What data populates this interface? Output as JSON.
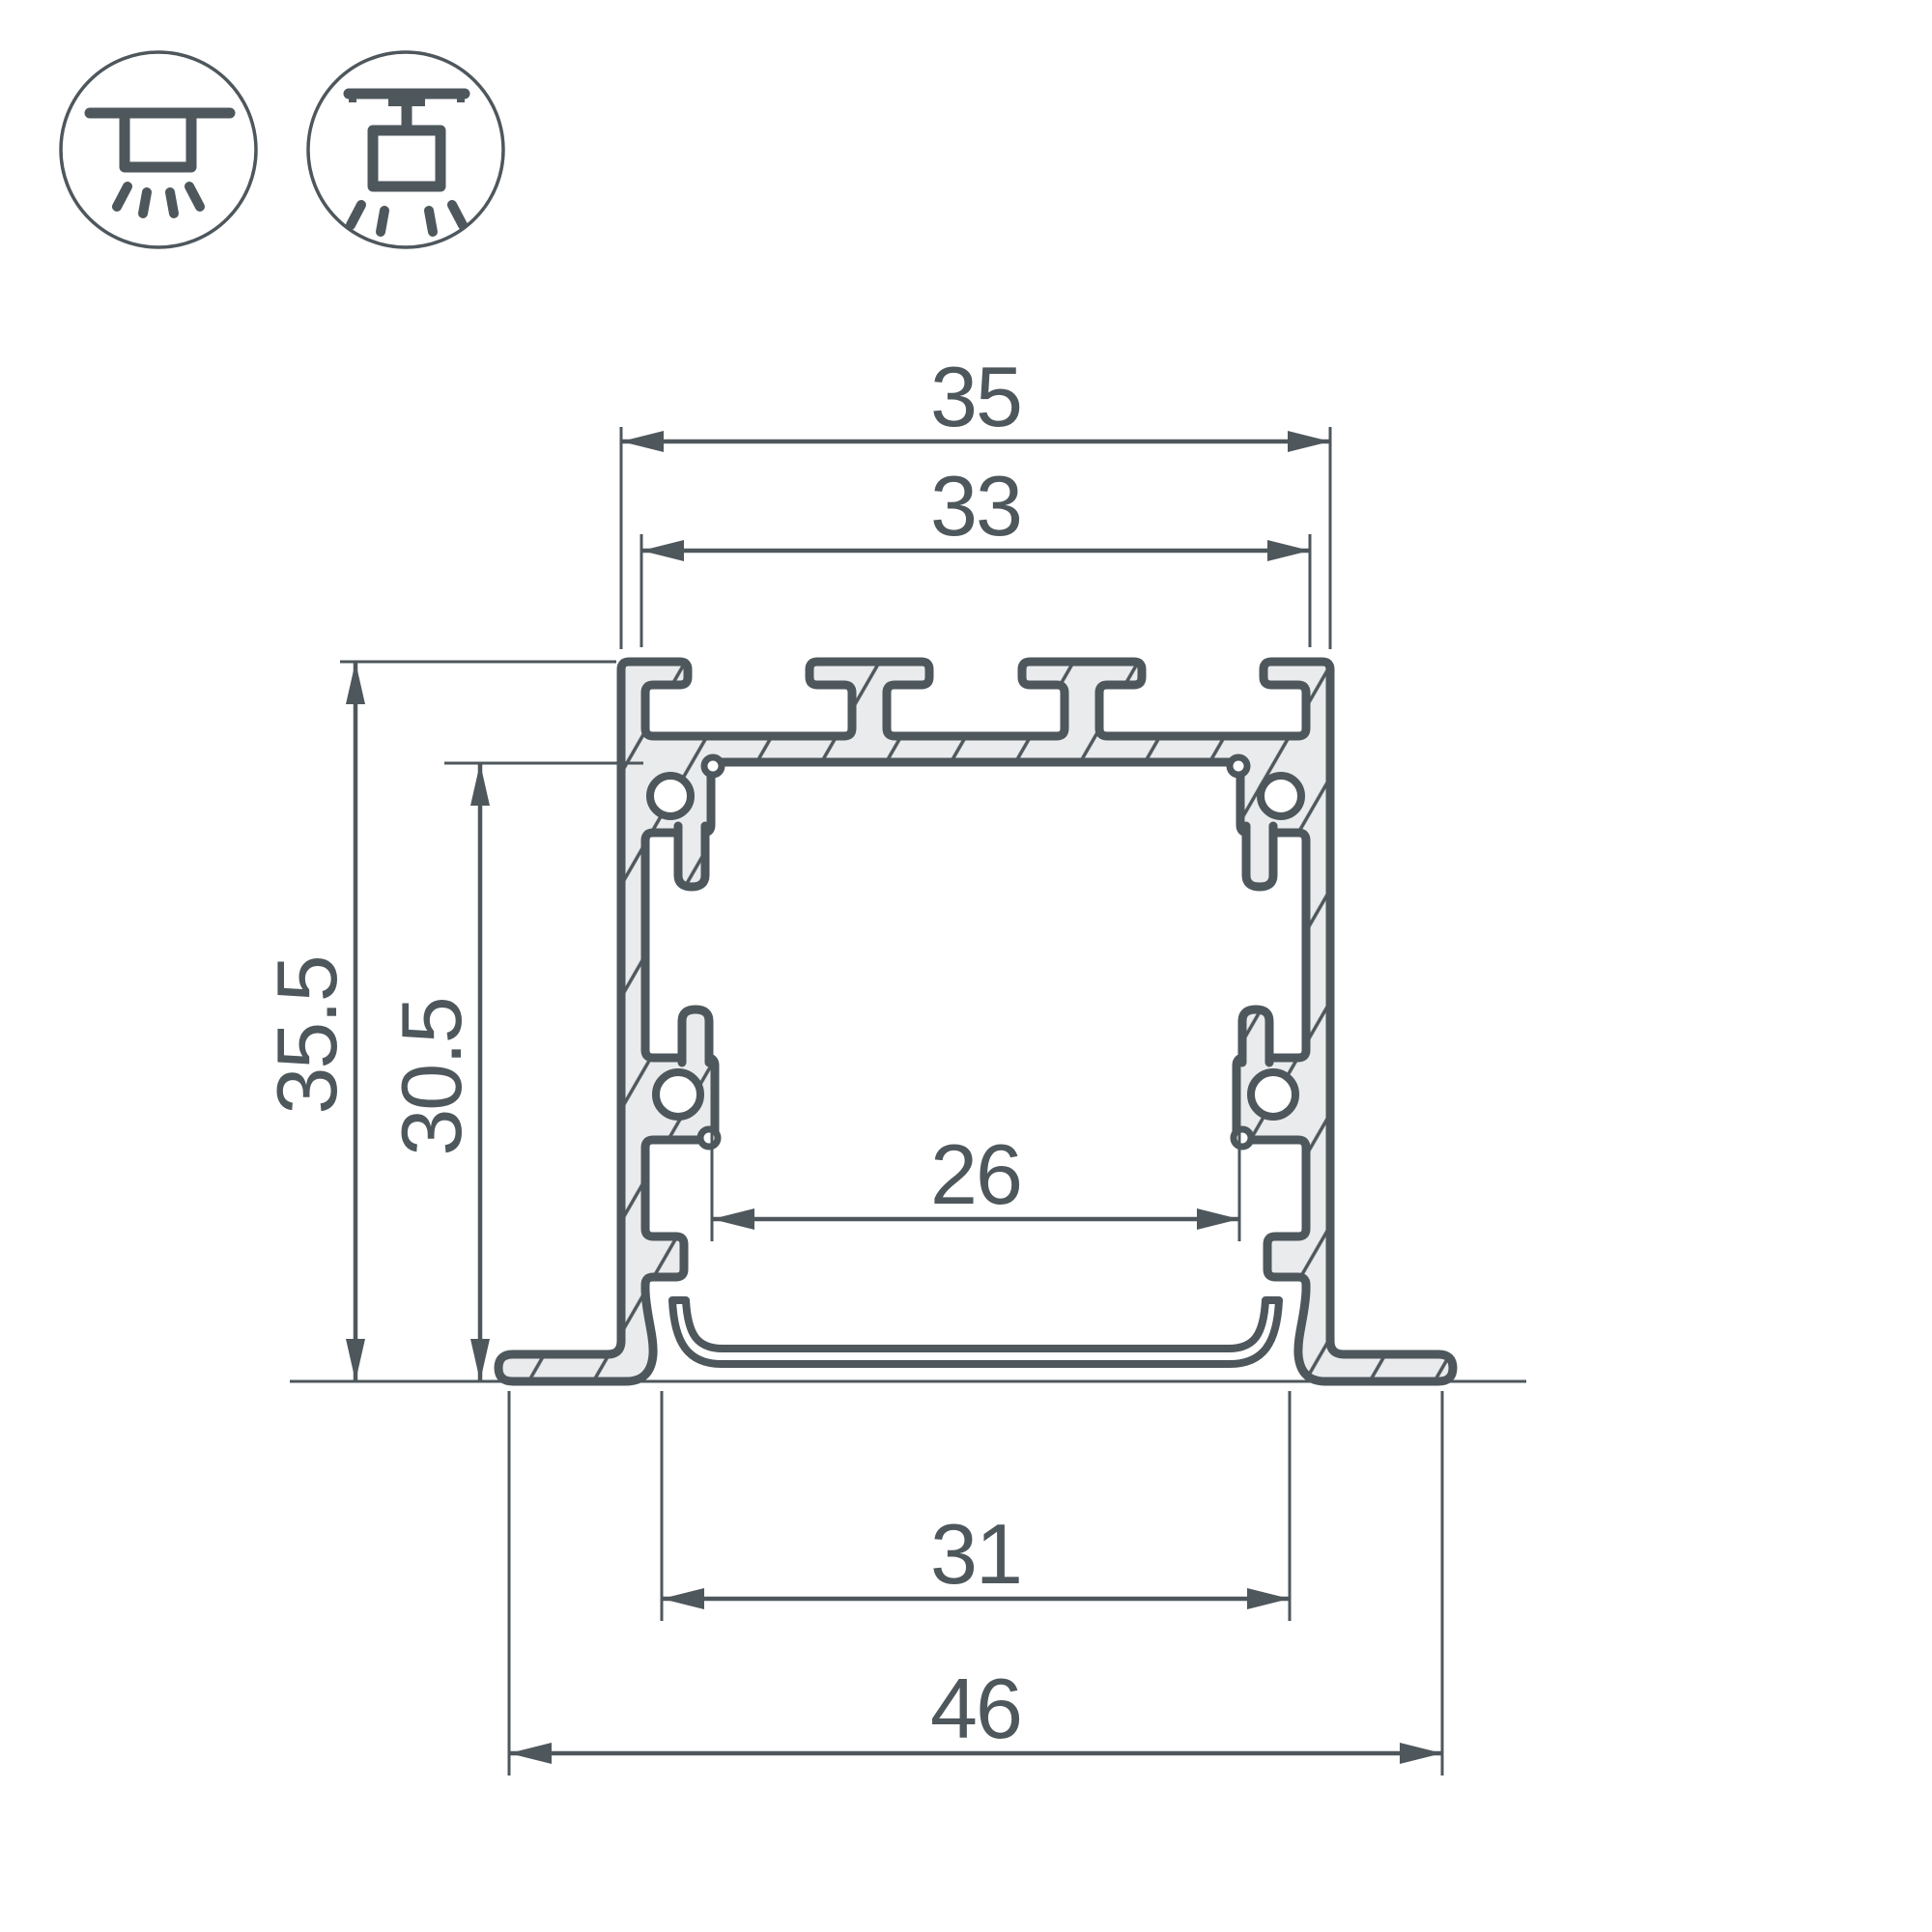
{
  "page": {
    "background": "#ffffff",
    "title": "LED profile cross-section technical drawing"
  },
  "icons": {
    "recessed_mount": {
      "name": "recessed-mount-icon",
      "meaning": "recessed ceiling installation"
    },
    "surface_mount": {
      "name": "surface-mount-icon",
      "meaning": "surface ceiling installation"
    }
  },
  "drawing": {
    "type": "technical-cross-section",
    "subject": "aluminium LED profile cross-section with mounting feet",
    "colors": {
      "line": "#4e575c",
      "material_fill": "#e9ebed",
      "background": "#ffffff"
    },
    "dimensions": {
      "top_outer_width": {
        "value": "35"
      },
      "top_inner_width": {
        "value": "33"
      },
      "overall_height": {
        "value": "35.5"
      },
      "inner_height": {
        "value": "30.5"
      },
      "inner_cavity_width": {
        "value": "26"
      },
      "recess_width": {
        "value": "31"
      },
      "overall_width": {
        "value": "46"
      }
    }
  }
}
